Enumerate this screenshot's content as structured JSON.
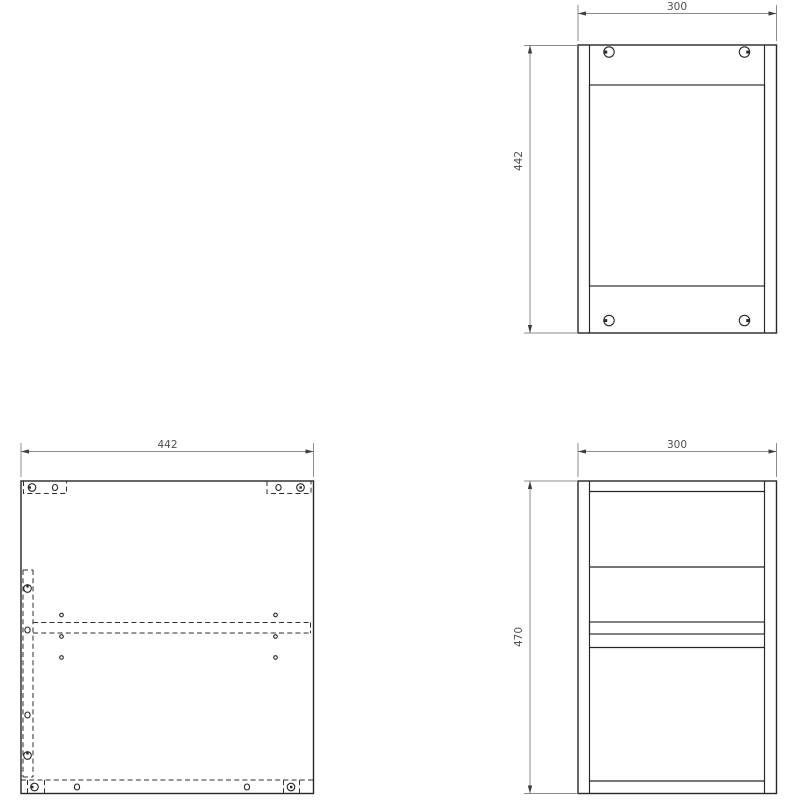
{
  "drawing": {
    "background_color": "#ffffff",
    "part_line_color": "#262626",
    "dimension_line_color": "#8c8c8c",
    "dimension_text_color": "#4f4f4f",
    "views": {
      "front": {
        "width_dim": "300",
        "height_dim": "442"
      },
      "panel": {
        "width_dim": "442"
      },
      "side": {
        "width_dim": "300",
        "height_dim": "470"
      }
    }
  }
}
